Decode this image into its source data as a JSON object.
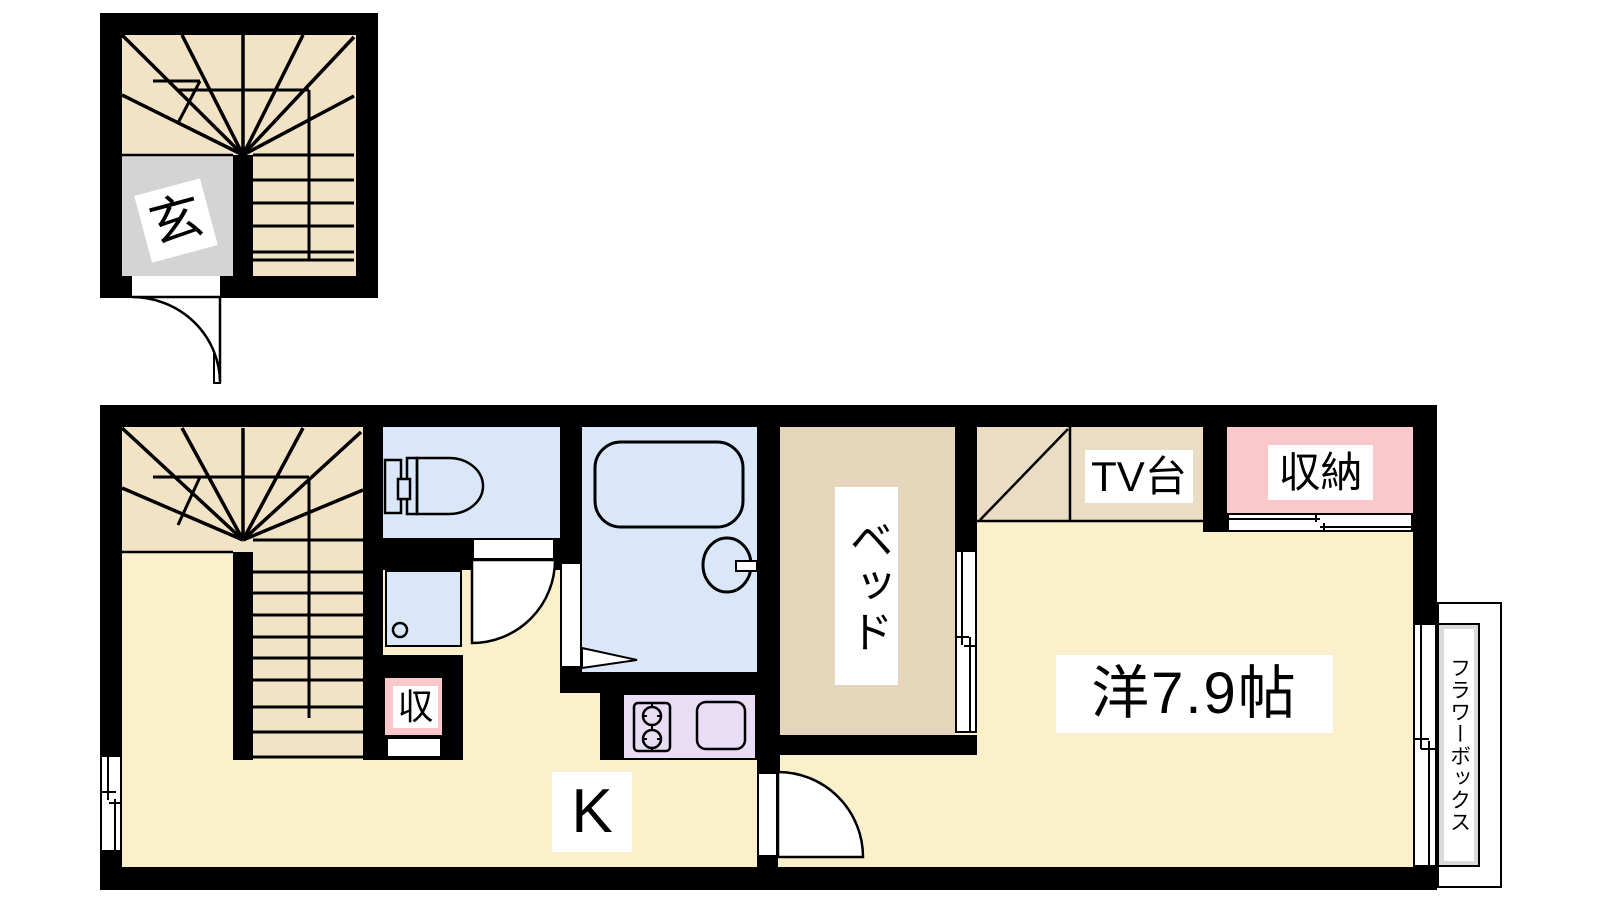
{
  "colors": {
    "wall": "#000000",
    "floor_yellow": "#FBF0CC",
    "stair_beige": "#F2E2C6",
    "bed_tan": "#E5D5BA",
    "tv_beige": "#EADDC4",
    "water_blue": "#D9E7F8",
    "closet_pink": "#FAC8CB",
    "kitchen_purple": "#E9DCF5",
    "entrance_gray": "#D4D4D4",
    "flowerbox_gray": "#DADADA"
  },
  "upper_floor": {
    "entrance": "玄"
  },
  "main_floor": {
    "kitchen": "K",
    "western_room": "洋7.9帖",
    "bed": "ベッド",
    "tv_stand": "TV台",
    "closet": "収納",
    "storage": "収",
    "flower_box": "フラワーボックス"
  }
}
